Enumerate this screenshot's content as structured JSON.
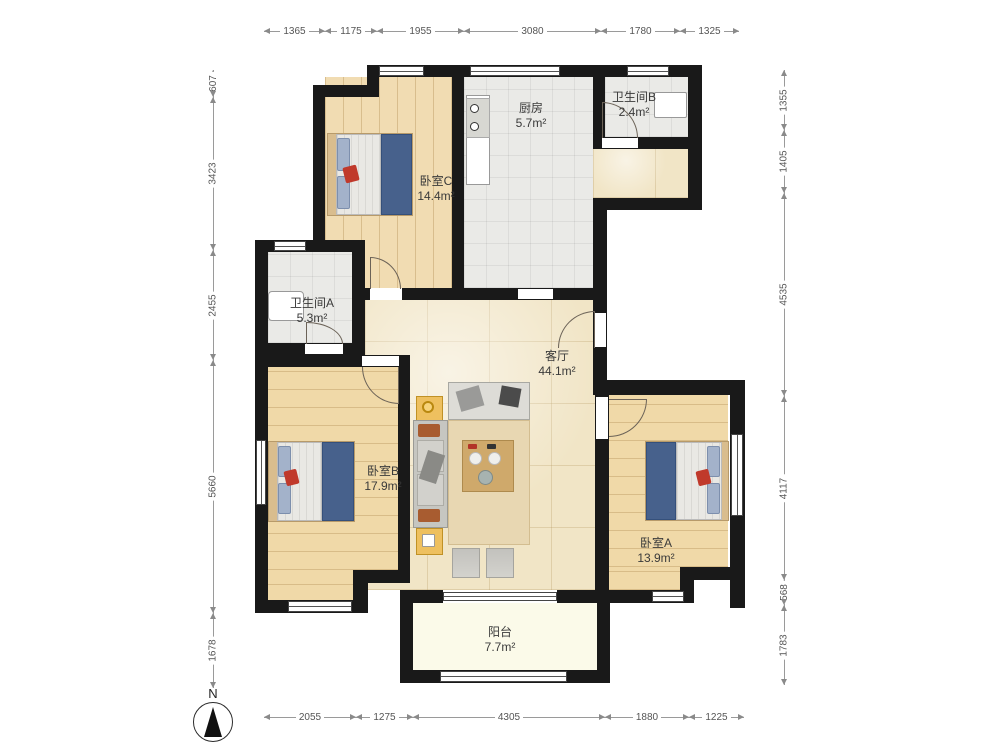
{
  "north": {
    "label": "N"
  },
  "rooms": [
    {
      "id": "bedroom-c",
      "name": "卧室C",
      "area": "14.4m²",
      "x": 436,
      "y": 189
    },
    {
      "id": "kitchen",
      "name": "厨房",
      "area": "5.7m²",
      "x": 531,
      "y": 116
    },
    {
      "id": "bathroom-b",
      "name": "卫生间B",
      "area": "2.4m²",
      "x": 634,
      "y": 105
    },
    {
      "id": "bathroom-a",
      "name": "卫生间A",
      "area": "5.3m²",
      "x": 312,
      "y": 311
    },
    {
      "id": "living-room",
      "name": "客厅",
      "area": "44.1m²",
      "x": 557,
      "y": 364
    },
    {
      "id": "bedroom-b",
      "name": "卧室B",
      "area": "17.9m²",
      "x": 383,
      "y": 479
    },
    {
      "id": "bedroom-a",
      "name": "卧室A",
      "area": "13.9m²",
      "x": 656,
      "y": 551
    },
    {
      "id": "balcony",
      "name": "阳台",
      "area": "7.7m²",
      "x": 500,
      "y": 640
    }
  ],
  "dimensions": {
    "top": {
      "y": 24,
      "segments": [
        {
          "label": "1365",
          "from": 264,
          "to": 325
        },
        {
          "label": "1175",
          "from": 325,
          "to": 377
        },
        {
          "label": "1955",
          "from": 377,
          "to": 464
        },
        {
          "label": "3080",
          "from": 464,
          "to": 601
        },
        {
          "label": "1780",
          "from": 601,
          "to": 680
        },
        {
          "label": "1325",
          "from": 680,
          "to": 739
        }
      ]
    },
    "bottom": {
      "y": 710,
      "segments": [
        {
          "label": "2055",
          "from": 264,
          "to": 356
        },
        {
          "label": "1275",
          "from": 356,
          "to": 413
        },
        {
          "label": "4305",
          "from": 413,
          "to": 605
        },
        {
          "label": "1880",
          "from": 605,
          "to": 689
        },
        {
          "label": "1225",
          "from": 689,
          "to": 744
        }
      ]
    },
    "left": {
      "x": 206,
      "segments": [
        {
          "label": "607",
          "from": 70,
          "to": 97
        },
        {
          "label": "3423",
          "from": 97,
          "to": 250
        },
        {
          "label": "2455",
          "from": 250,
          "to": 360
        },
        {
          "label": "5660",
          "from": 360,
          "to": 613
        },
        {
          "label": "1678",
          "from": 613,
          "to": 688
        }
      ]
    },
    "right": {
      "x": 777,
      "segments": [
        {
          "label": "1355",
          "from": 70,
          "to": 130
        },
        {
          "label": "1405",
          "from": 130,
          "to": 193
        },
        {
          "label": "4535",
          "from": 193,
          "to": 396
        },
        {
          "label": "4117",
          "from": 396,
          "to": 580
        },
        {
          "label": "568",
          "from": 580,
          "to": 605
        },
        {
          "label": "1783",
          "from": 605,
          "to": 685
        }
      ]
    }
  },
  "colors": {
    "wall": "#191919",
    "wood_floor": "#f0d9a8",
    "tile_floor": "#eaeae7",
    "marble_floor": "#f1e5c6",
    "balcony_floor": "#fbfae9",
    "blanket_blue": "#47618c",
    "accent_red": "#c0392b",
    "end_table_yellow": "#eec05f"
  }
}
